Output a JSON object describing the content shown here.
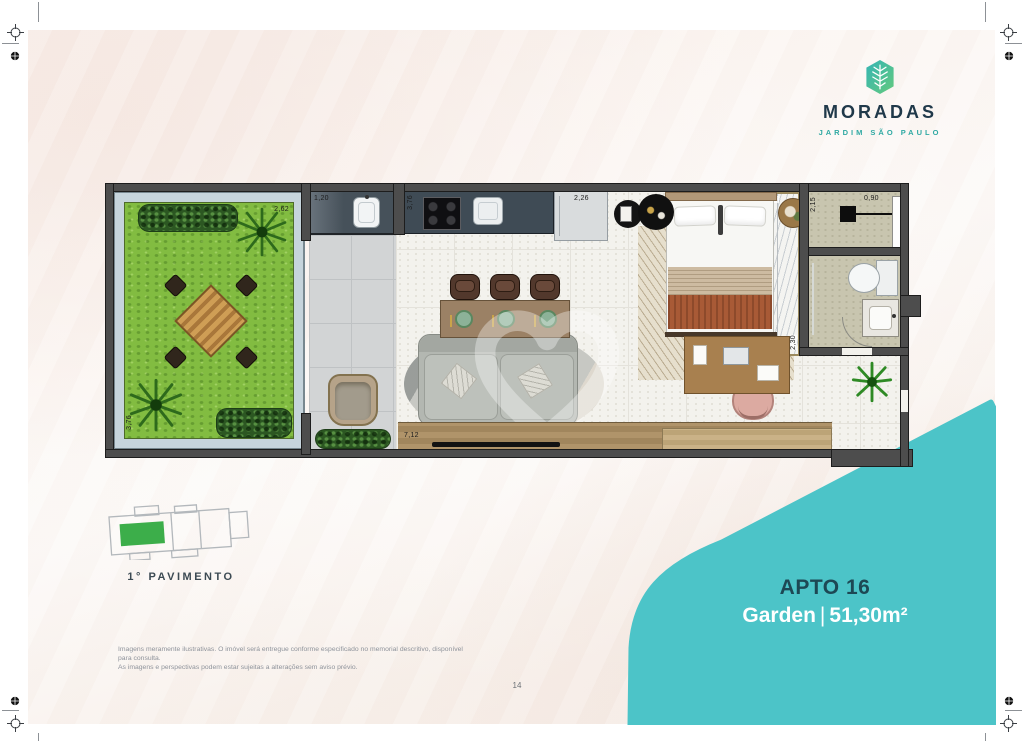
{
  "brand": {
    "name": "MORADAS",
    "tagline": "JARDIM SÃO PAULO",
    "navy": "#20394a",
    "teal": "#2fa9a3"
  },
  "unit_badge": {
    "title": "APTO 16",
    "type": "Garden",
    "separator": "|",
    "area": "51,30m²",
    "background": "#4cc4c8"
  },
  "keyplan": {
    "label": "1° PAVIMENTO",
    "highlight_color": "#3cae4a"
  },
  "plan": {
    "measurements": {
      "garden_width": "2,62",
      "garden_depth": "3,76",
      "laundry_width": "1,20",
      "kitchen_depth": "3,76",
      "kitchen_width": "2,26",
      "bedroom_width": "3,42",
      "shower_depth": "2,15",
      "shower_width": "0,90",
      "closet_depth": "2,30",
      "living_width": "7,12"
    }
  },
  "footer": {
    "disclaimer_line1": "Imagens meramente ilustrativas. O imóvel será entregue conforme especificado no memorial descritivo, disponível para consulta.",
    "disclaimer_line2": "As imagens e perspectivas podem estar sujeitas a alterações sem aviso prévio.",
    "page_number": "14"
  }
}
